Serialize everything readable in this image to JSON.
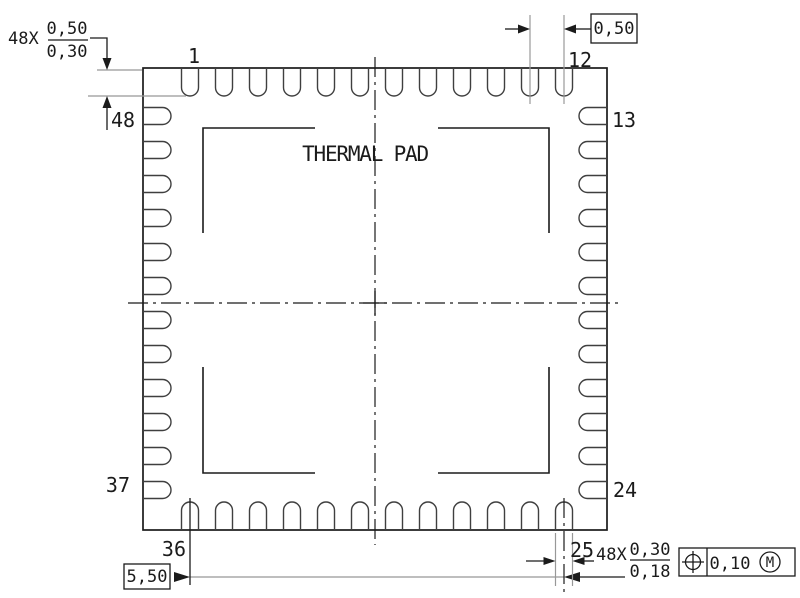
{
  "drawing": {
    "center_label": "THERMAL PAD",
    "pins_per_side": 12,
    "total_pins": 48,
    "pin_labels": {
      "pin1": "1",
      "pin12": "12",
      "pin13": "13",
      "pin24": "24",
      "pin25": "25",
      "pin36": "36",
      "pin37": "37",
      "pin48": "48"
    },
    "dim_pin_length": {
      "count": "48X",
      "max": "0,50",
      "min": "0,30"
    },
    "dim_pitch": {
      "value": "0,50"
    },
    "dim_span": {
      "value": "5,50"
    },
    "dim_pin_width": {
      "count": "48X",
      "max": "0,30",
      "min": "0,18"
    },
    "tolerance_frame": {
      "symbol": "position",
      "value": "0,10",
      "modifier": "M"
    },
    "colors": {
      "line": "#1b1b1b",
      "pin": "#3f3f3f",
      "dim_line": "#989898",
      "background": "#ffffff"
    }
  }
}
